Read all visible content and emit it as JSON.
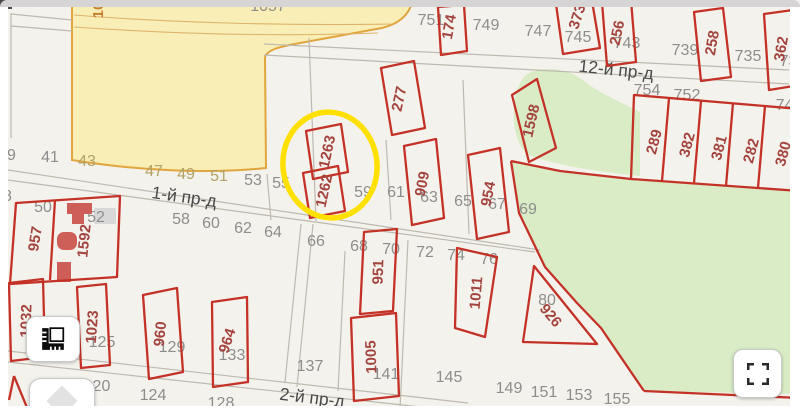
{
  "colors": {
    "map_background": "#f4f2ec",
    "parcel_outline": "#c43227",
    "parcel_label": "#a4443f",
    "house_number": "#8d8d8d",
    "tan_number": "#b3a265",
    "street_label": "#4a4a4a",
    "land_yellow": "#f9efb6",
    "land_yellow_border": "#e1a53d",
    "vegetation_green": "#d9ecc6",
    "highlight_yellow": "#ffe000"
  },
  "highlight": {
    "parcels": [
      "1262",
      "1263"
    ],
    "color": "#ffe000"
  },
  "streets": [
    {
      "label": "1-й пр-д",
      "x": 184,
      "y": 198,
      "rot": 8
    },
    {
      "label": "2-й пр-д",
      "x": 312,
      "y": 399,
      "rot": 7
    },
    {
      "label": "12-й пр-д",
      "x": 616,
      "y": 71,
      "rot": 6
    }
  ],
  "parcel_labels": [
    {
      "t": "174",
      "x": 450,
      "y": 27,
      "rot": -80
    },
    {
      "t": "373",
      "x": 578,
      "y": 17,
      "rot": -72
    },
    {
      "t": "256",
      "x": 618,
      "y": 33,
      "rot": -78
    },
    {
      "t": "258",
      "x": 713,
      "y": 43,
      "rot": -80
    },
    {
      "t": "362",
      "x": 782,
      "y": 49,
      "rot": -80
    },
    {
      "t": "277",
      "x": 400,
      "y": 99,
      "rot": -78
    },
    {
      "t": "1598",
      "x": 532,
      "y": 121,
      "rot": -77
    },
    {
      "t": "1263",
      "x": 328,
      "y": 152,
      "rot": -78
    },
    {
      "t": "1262",
      "x": 325,
      "y": 191,
      "rot": -78
    },
    {
      "t": "909",
      "x": 423,
      "y": 184,
      "rot": -79
    },
    {
      "t": "954",
      "x": 489,
      "y": 194,
      "rot": -79
    },
    {
      "t": "289",
      "x": 655,
      "y": 142,
      "rot": -75
    },
    {
      "t": "382",
      "x": 688,
      "y": 145,
      "rot": -75
    },
    {
      "t": "381",
      "x": 720,
      "y": 148,
      "rot": -75
    },
    {
      "t": "282",
      "x": 752,
      "y": 151,
      "rot": -75
    },
    {
      "t": "380",
      "x": 784,
      "y": 154,
      "rot": -75
    },
    {
      "t": "957",
      "x": 36,
      "y": 239,
      "rot": -81
    },
    {
      "t": "1592",
      "x": 85,
      "y": 241,
      "rot": -84
    },
    {
      "t": "1032",
      "x": 27,
      "y": 321,
      "rot": -88
    },
    {
      "t": "1023",
      "x": 93,
      "y": 327,
      "rot": -86
    },
    {
      "t": "960",
      "x": 161,
      "y": 334,
      "rot": -84
    },
    {
      "t": "964",
      "x": 228,
      "y": 341,
      "rot": -72
    },
    {
      "t": "951",
      "x": 379,
      "y": 272,
      "rot": -88
    },
    {
      "t": "1005",
      "x": 372,
      "y": 357,
      "rot": -92
    },
    {
      "t": "1011",
      "x": 477,
      "y": 293,
      "rot": -85
    },
    {
      "t": "926",
      "x": 550,
      "y": 316,
      "rot": 50
    },
    {
      "t": "10",
      "x": 99,
      "y": 10,
      "rot": -90,
      "c": "orange"
    }
  ],
  "house_numbers": [
    {
      "t": "39",
      "x": 7,
      "y": 156
    },
    {
      "t": "41",
      "x": 50,
      "y": 158
    },
    {
      "t": "43",
      "x": 87,
      "y": 162,
      "c": "tan"
    },
    {
      "t": "47",
      "x": 154,
      "y": 172,
      "c": "tan"
    },
    {
      "t": "49",
      "x": 186,
      "y": 175,
      "c": "tan"
    },
    {
      "t": "51",
      "x": 219,
      "y": 177,
      "c": "tan"
    },
    {
      "t": "53",
      "x": 253,
      "y": 181
    },
    {
      "t": "55",
      "x": 281,
      "y": 184
    },
    {
      "t": "59",
      "x": 363,
      "y": 193
    },
    {
      "t": "61",
      "x": 396,
      "y": 193
    },
    {
      "t": "63",
      "x": 429,
      "y": 198
    },
    {
      "t": "65",
      "x": 463,
      "y": 202
    },
    {
      "t": "67",
      "x": 497,
      "y": 205
    },
    {
      "t": "69",
      "x": 528,
      "y": 210
    },
    {
      "t": "48",
      "x": 3,
      "y": 197
    },
    {
      "t": "50",
      "x": 43,
      "y": 208
    },
    {
      "t": "52",
      "x": 96,
      "y": 218
    },
    {
      "t": "58",
      "x": 181,
      "y": 220
    },
    {
      "t": "60",
      "x": 211,
      "y": 224
    },
    {
      "t": "62",
      "x": 243,
      "y": 229
    },
    {
      "t": "64",
      "x": 273,
      "y": 233
    },
    {
      "t": "66",
      "x": 316,
      "y": 242
    },
    {
      "t": "68",
      "x": 359,
      "y": 247
    },
    {
      "t": "70",
      "x": 391,
      "y": 250
    },
    {
      "t": "72",
      "x": 425,
      "y": 253
    },
    {
      "t": "74",
      "x": 456,
      "y": 256
    },
    {
      "t": "76",
      "x": 489,
      "y": 260
    },
    {
      "t": "80",
      "x": 547,
      "y": 301
    },
    {
      "t": "123",
      "x": 68,
      "y": 338
    },
    {
      "t": "125",
      "x": 102,
      "y": 343
    },
    {
      "t": "129",
      "x": 172,
      "y": 348
    },
    {
      "t": "133",
      "x": 232,
      "y": 356
    },
    {
      "t": "137",
      "x": 310,
      "y": 367
    },
    {
      "t": "141",
      "x": 386,
      "y": 375
    },
    {
      "t": "120",
      "x": 97,
      "y": 387
    },
    {
      "t": "124",
      "x": 153,
      "y": 396
    },
    {
      "t": "128",
      "x": 221,
      "y": 404
    },
    {
      "t": "145",
      "x": 449,
      "y": 378
    },
    {
      "t": "149",
      "x": 509,
      "y": 389
    },
    {
      "t": "151",
      "x": 544,
      "y": 393
    },
    {
      "t": "153",
      "x": 579,
      "y": 396
    },
    {
      "t": "155",
      "x": 617,
      "y": 400
    },
    {
      "t": "751",
      "x": 431,
      "y": 21
    },
    {
      "t": "749",
      "x": 486,
      "y": 26
    },
    {
      "t": "747",
      "x": 538,
      "y": 32
    },
    {
      "t": "745",
      "x": 578,
      "y": 38
    },
    {
      "t": "743",
      "x": 627,
      "y": 44
    },
    {
      "t": "739",
      "x": 685,
      "y": 51
    },
    {
      "t": "735",
      "x": 748,
      "y": 57
    },
    {
      "t": "731",
      "x": 793,
      "y": 62
    },
    {
      "t": "754",
      "x": 647,
      "y": 91
    },
    {
      "t": "752",
      "x": 687,
      "y": 96
    },
    {
      "t": "748",
      "x": 789,
      "y": 106
    },
    {
      "t": "1057",
      "x": 268,
      "y": 7
    }
  ],
  "controls": {
    "measure": {
      "icon": "ruler-icon"
    },
    "expand": {
      "icon": "diamond-icon"
    },
    "fullscreen": {
      "icon": "fullscreen-icon"
    }
  }
}
